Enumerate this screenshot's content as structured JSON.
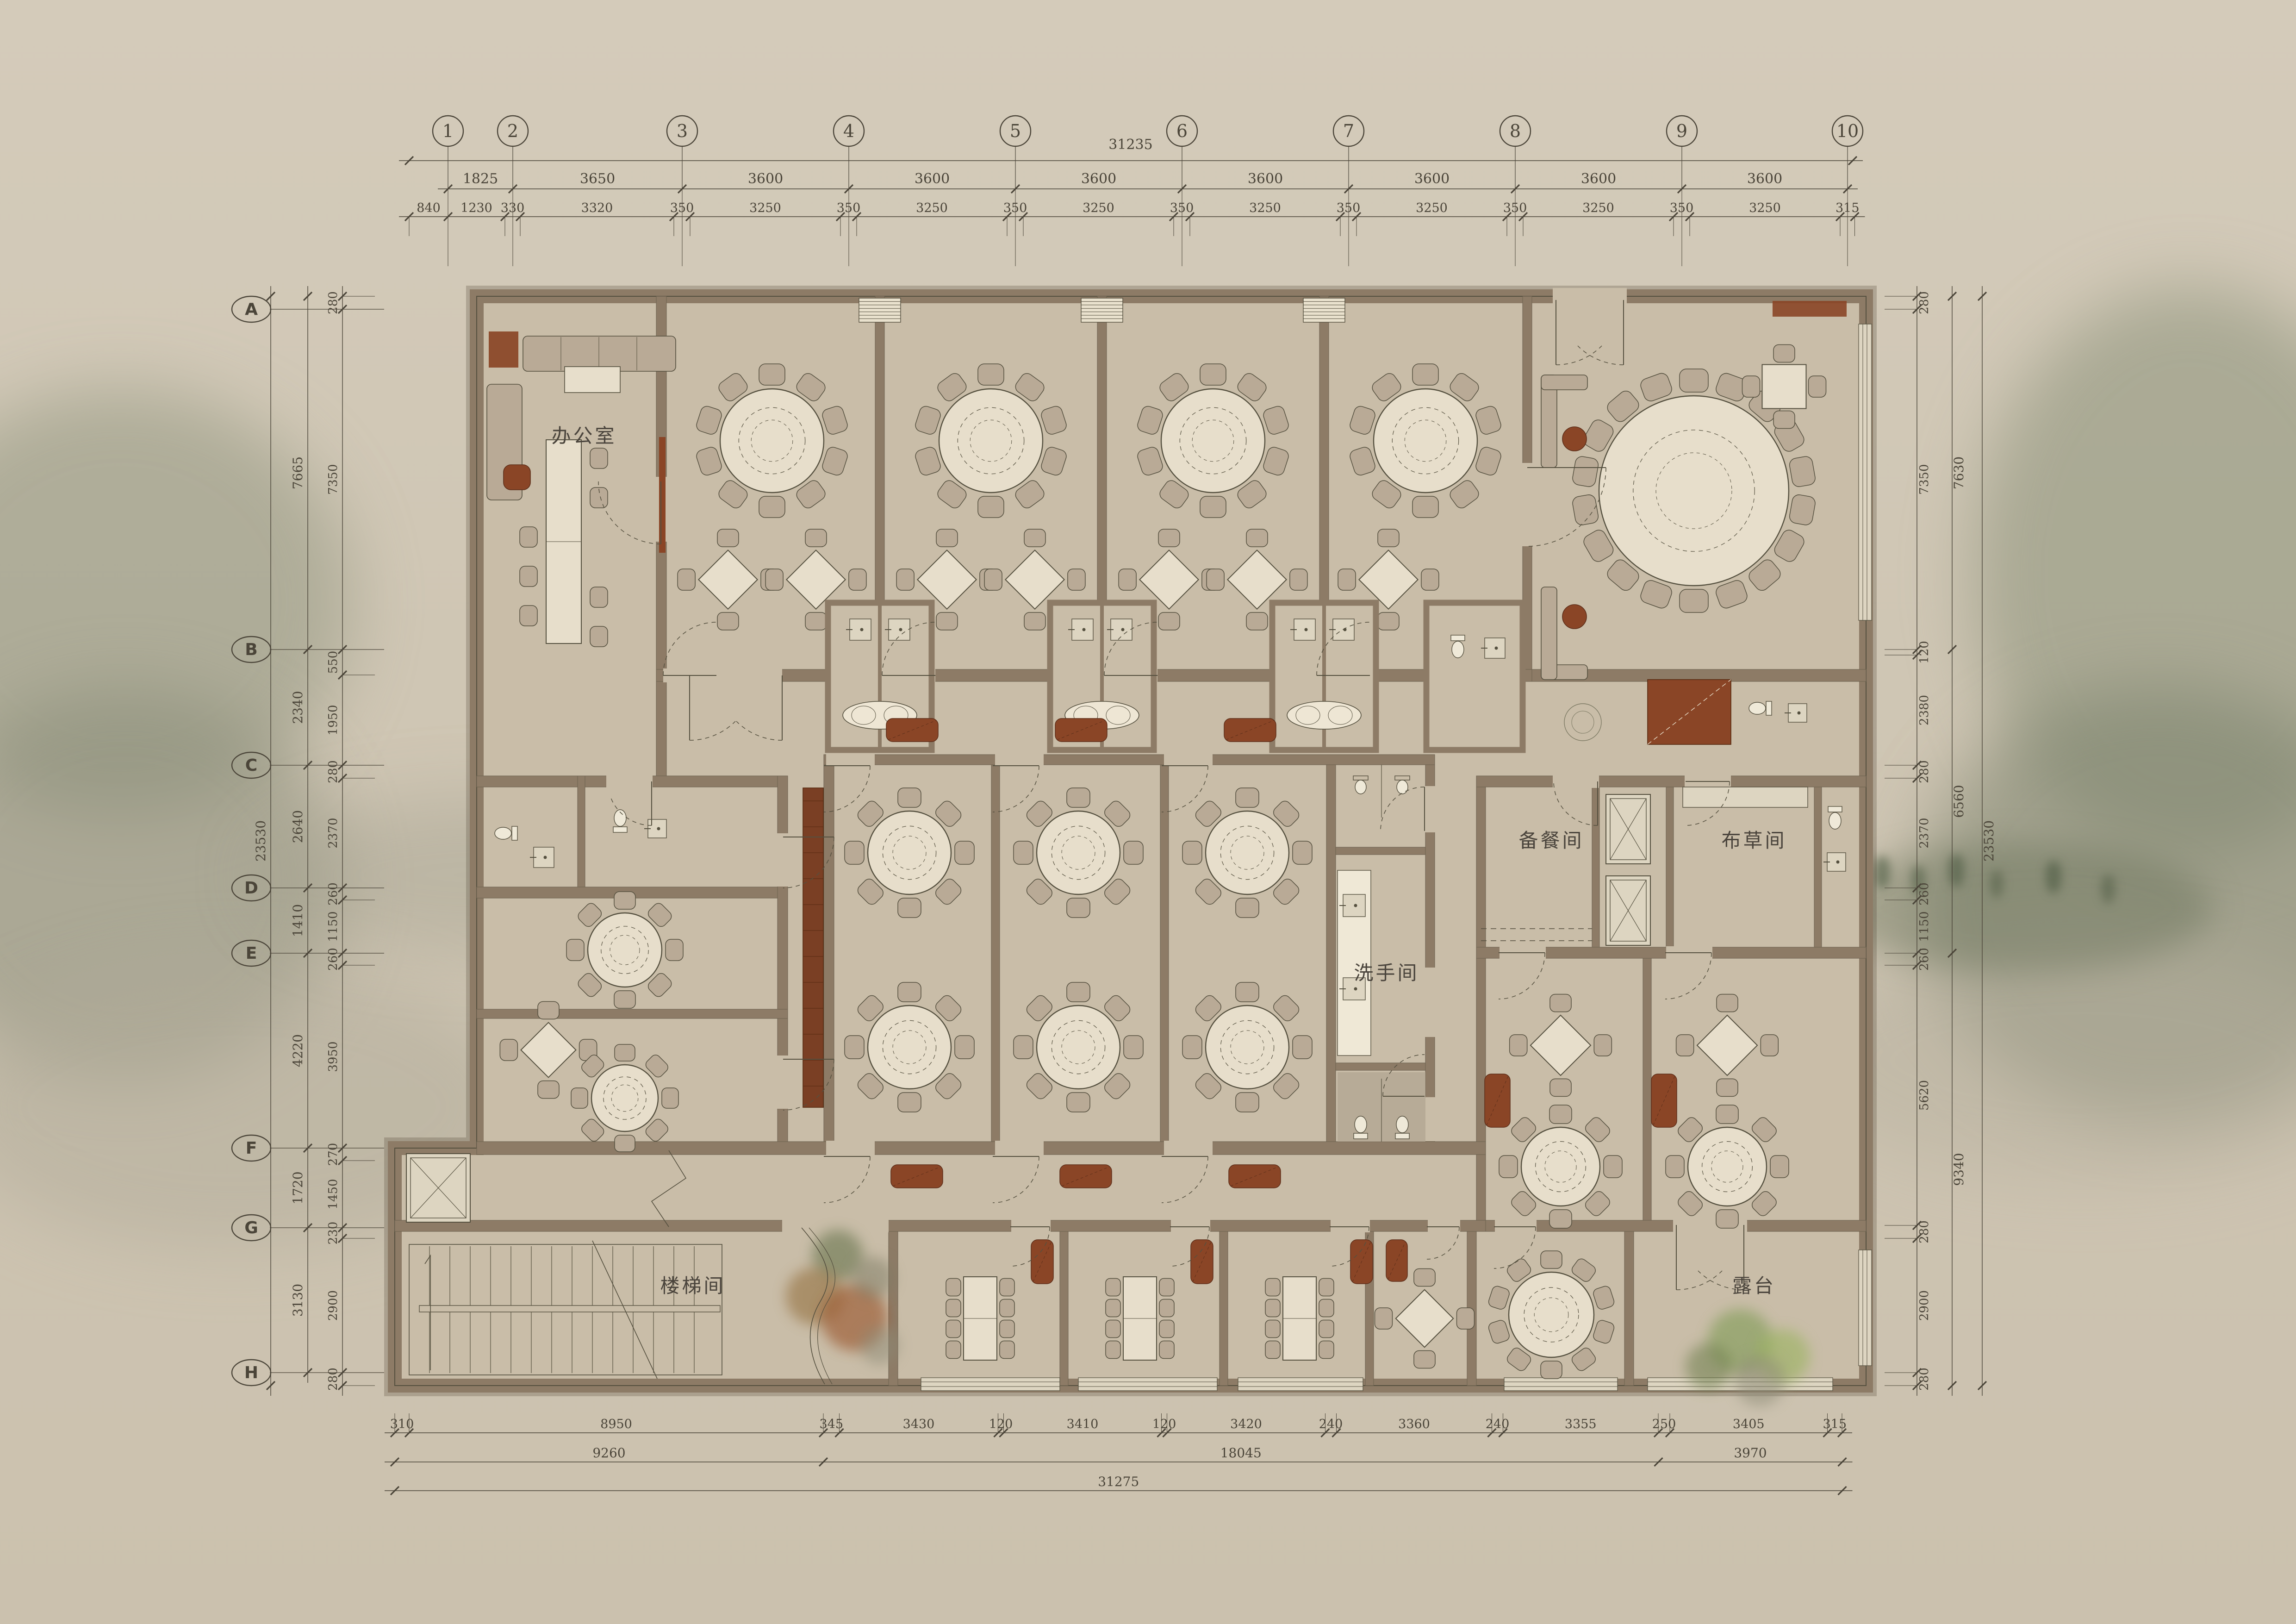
{
  "grid": {
    "columns": [
      "1",
      "2",
      "3",
      "4",
      "5",
      "6",
      "7",
      "8",
      "9",
      "10"
    ],
    "rows": [
      "A",
      "B",
      "C",
      "D",
      "E",
      "F",
      "G",
      "H"
    ]
  },
  "dims": {
    "top": {
      "overall": "31235",
      "major": [
        "1825",
        "3650",
        "3600",
        "3600",
        "3600",
        "3600",
        "3600",
        "3600",
        "3600"
      ],
      "minor": [
        "840",
        "1230",
        "330",
        "3320",
        "350",
        "3250",
        "350",
        "3250",
        "350",
        "3250",
        "350",
        "3250",
        "350",
        "3250",
        "350",
        "3250",
        "350",
        "3250",
        "315"
      ]
    },
    "bottom": {
      "row1": [
        "310",
        "8950",
        "345",
        "3430",
        "120",
        "3410",
        "120",
        "3420",
        "240",
        "3360",
        "240",
        "3355",
        "250",
        "3405",
        "315"
      ],
      "row2": [
        "9260",
        "18045",
        "3970"
      ],
      "row3": [
        "31275"
      ]
    },
    "left": {
      "outer": [
        "23530"
      ],
      "middle": [
        "7665",
        "2340",
        "2640",
        "1410",
        "4220",
        "1720",
        "3130"
      ],
      "inner": [
        "280",
        "7350",
        "550",
        "1950",
        "280",
        "2370",
        "260",
        "1150",
        "260",
        "3950",
        "270",
        "1450",
        "230",
        "2900",
        "280"
      ]
    },
    "right": {
      "inner": [
        "280",
        "7350",
        "120",
        "2380",
        "280",
        "2370",
        "260",
        "1150",
        "260",
        "5620",
        "280",
        "2900",
        "280"
      ],
      "middle": [
        "7630",
        "6560",
        "9340"
      ],
      "outer": [
        "23530"
      ]
    }
  },
  "rooms": {
    "office": "办公室",
    "washroom": "洗手间",
    "pantry": "备餐间",
    "linen": "布草间",
    "stairwell": "楼梯间",
    "terrace": "露台"
  },
  "colors": {
    "background": "#cfc6b4",
    "floor": "#c9bda8",
    "wall": "#8d7b66",
    "line": "#55503f",
    "dim": "#4b4539",
    "table": "#e7decb",
    "chair": "#b9aa96",
    "brown": "#8a4526",
    "window": "#ddd5c1",
    "tile": "#b3a692",
    "text": "#4a443c",
    "treeGreen": "#7f9b55",
    "treeOrange": "#9c5a33"
  }
}
